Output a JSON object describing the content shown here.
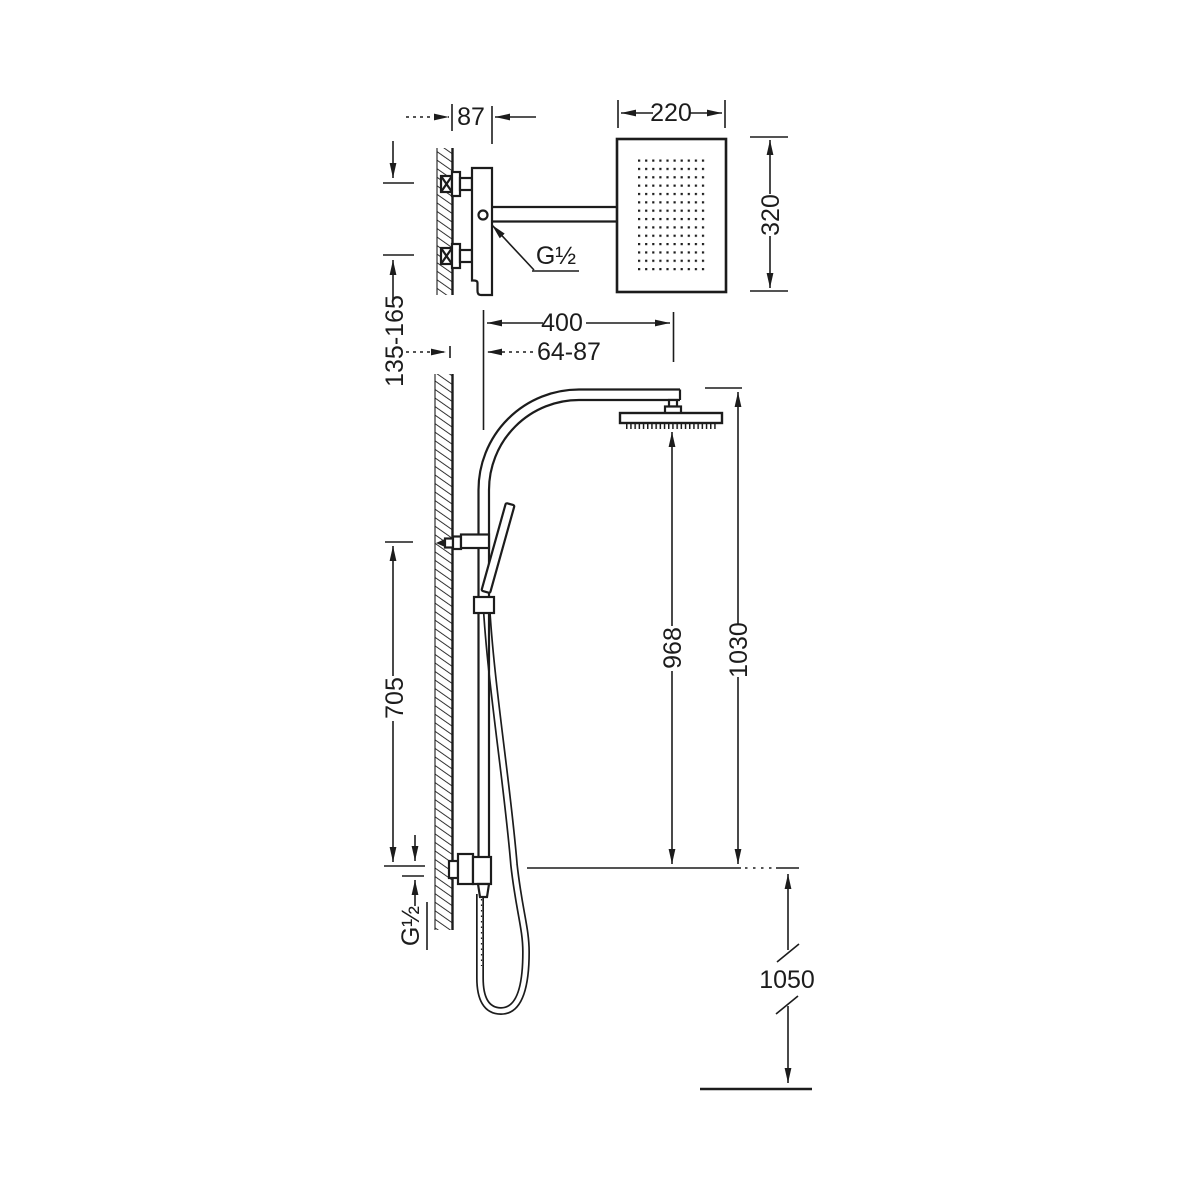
{
  "window": {
    "width": 1200,
    "height": 1200,
    "background": "#ffffff"
  },
  "drawing": {
    "type": "technical-dimension-drawing",
    "subject": "wall-mounted shower column with rain head and hand shower",
    "line_color": "#1c1c1c",
    "labels": {
      "arm_offset": "87",
      "head_width": "220",
      "head_height": "320",
      "top_thread": "G½",
      "arm_reach": "400",
      "wall_to_column": "64-87",
      "inlet_spacing": "135-165",
      "holder_to_outlet": "705",
      "head_to_base": "968",
      "top_to_base": "1030",
      "base_height": "1050",
      "bottom_thread": "G½"
    }
  }
}
